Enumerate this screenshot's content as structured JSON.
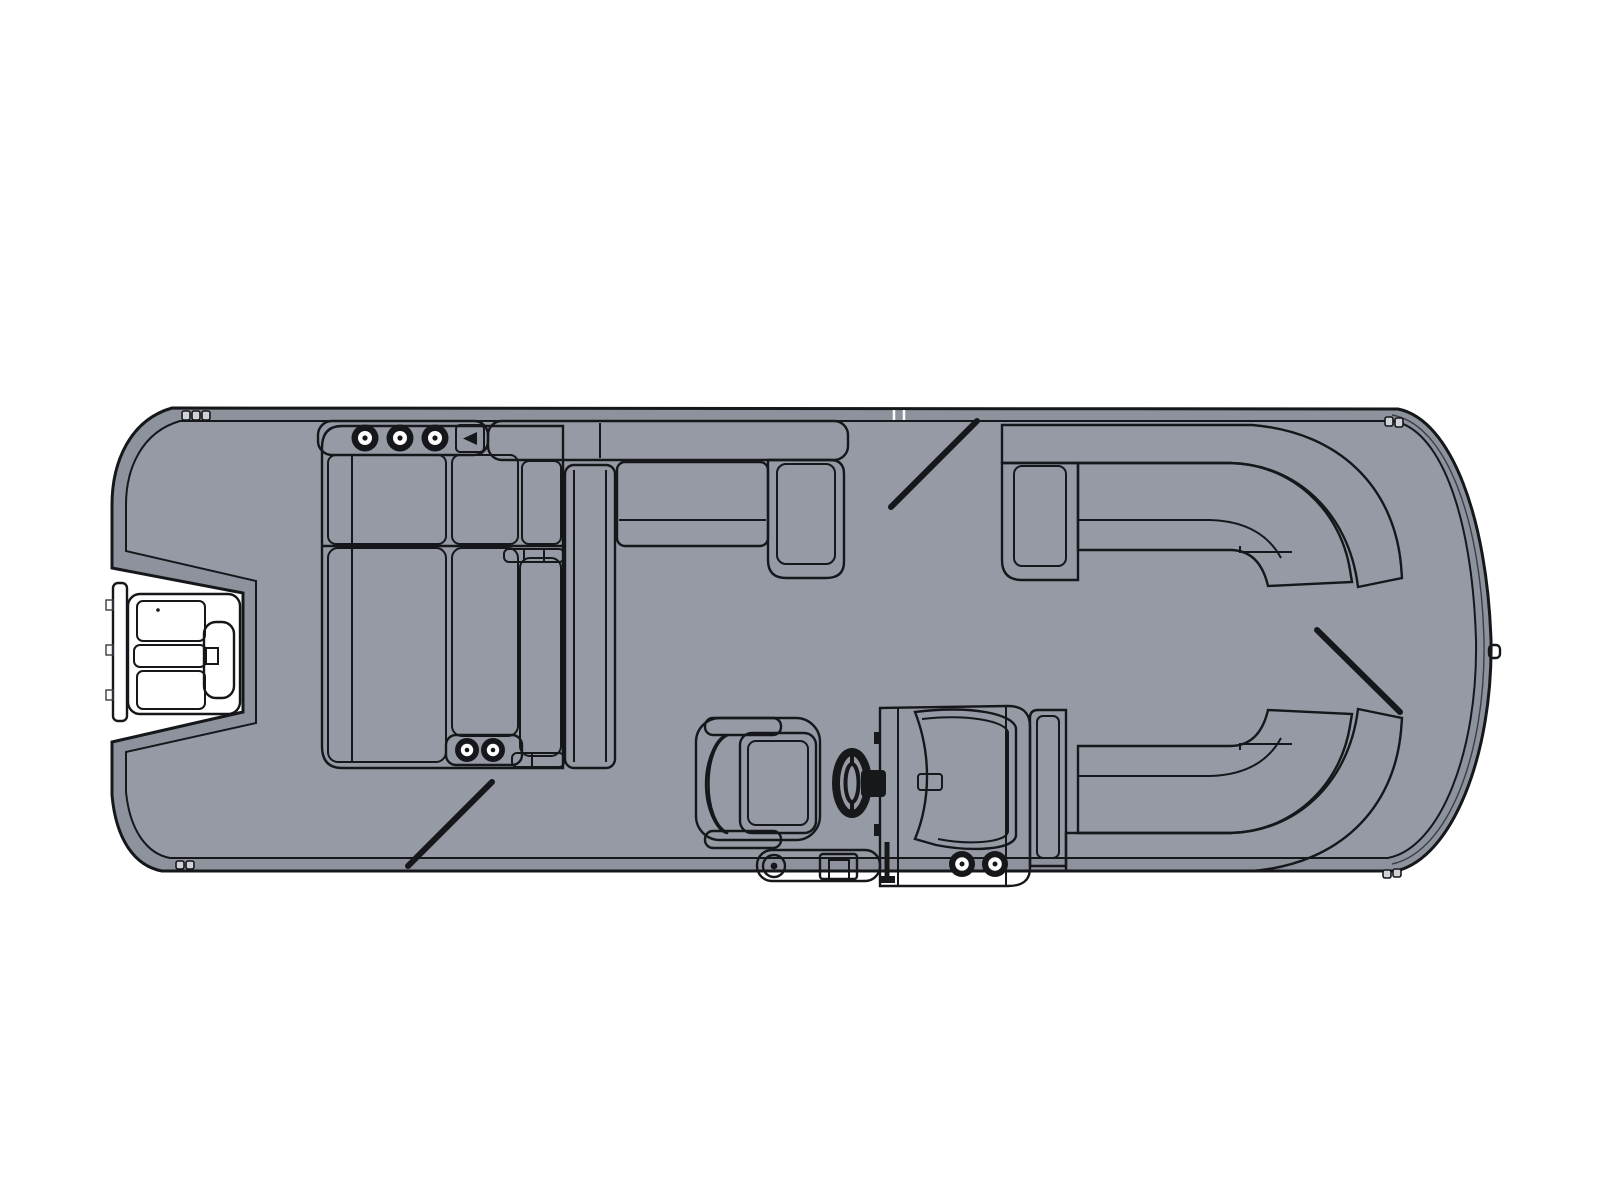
{
  "diagram": {
    "title": "Pontoon boat floorplan, top view",
    "orientation": "bow-right, stern-left",
    "components": {
      "engine": "outboard motor on stern bracket",
      "aft_facing_lounges": {
        "cupholders_aft_armrest": 3,
        "cupholders_forward_armrest": 2,
        "seats": "two facing bench lounges"
      },
      "port_side_bench": "L-shaped bench with end armrest",
      "bow_port_lounge": "curved wraparound corner lounge",
      "bow_starboard_lounge": "curved wraparound corner lounge",
      "helm": {
        "steering_wheel": true,
        "windscreen": true,
        "cupholders": 2
      },
      "captain_chair": "swivel captain chair facing helm",
      "gate_marks": 3,
      "bow_light": true
    }
  },
  "colors": {
    "background": "#ffffff",
    "rim": "#8d929d",
    "deck": "#959aa5",
    "outline": "#15171a",
    "seat_light": "#f4f5f7",
    "seat_shade": "#d6d9de",
    "hardware_dark": "#17181a"
  }
}
